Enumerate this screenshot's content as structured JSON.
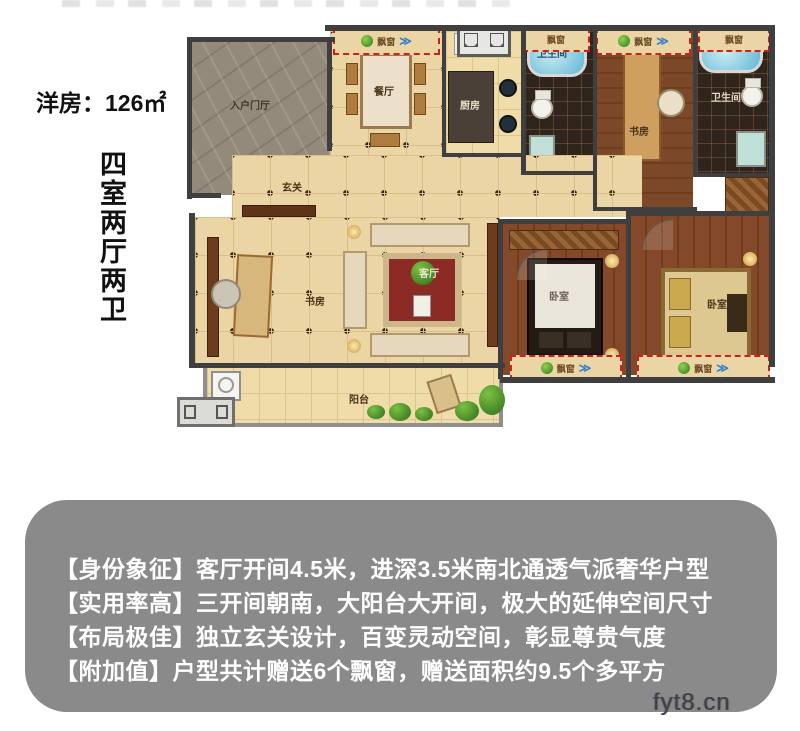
{
  "title_area": {
    "area_label": "洋房：126㎡",
    "layout_label": "四室两厅两卫"
  },
  "plan": {
    "labels": {
      "entry_hall": "入户门厅",
      "dining": "餐厅",
      "kitchen": "厨房",
      "bathroom1": "卫生间",
      "bathroom2": "卫生间",
      "study_top": "书房",
      "study_left": "书房",
      "foyer": "玄关",
      "living": "客厅",
      "bedroom1": "卧室",
      "bedroom2": "卧室",
      "balcony": "阳台",
      "bay_window": "飘窗"
    },
    "colors": {
      "bay_dash_red": "#cf2020",
      "floor_tile": "#ecd5a4",
      "wood_floor": "#7c482a",
      "wall": "#3f3f3f",
      "carpet_red": "#8c2b25"
    }
  },
  "info_card": {
    "bg": "#8a8a8a",
    "lines": [
      "【身份象征】客厅开间4.5米，进深3.5米南北通透气派奢华户型",
      "【实用率高】三开间朝南，大阳台大开间，极大的延伸空间尺寸",
      "【布局极佳】独立玄关设计，百变灵动空间，彰显尊贵气度",
      "【附加值】户型共计赠送6个飘窗，赠送面积约9.5个多平方"
    ]
  },
  "watermark": "fyt8.cn"
}
